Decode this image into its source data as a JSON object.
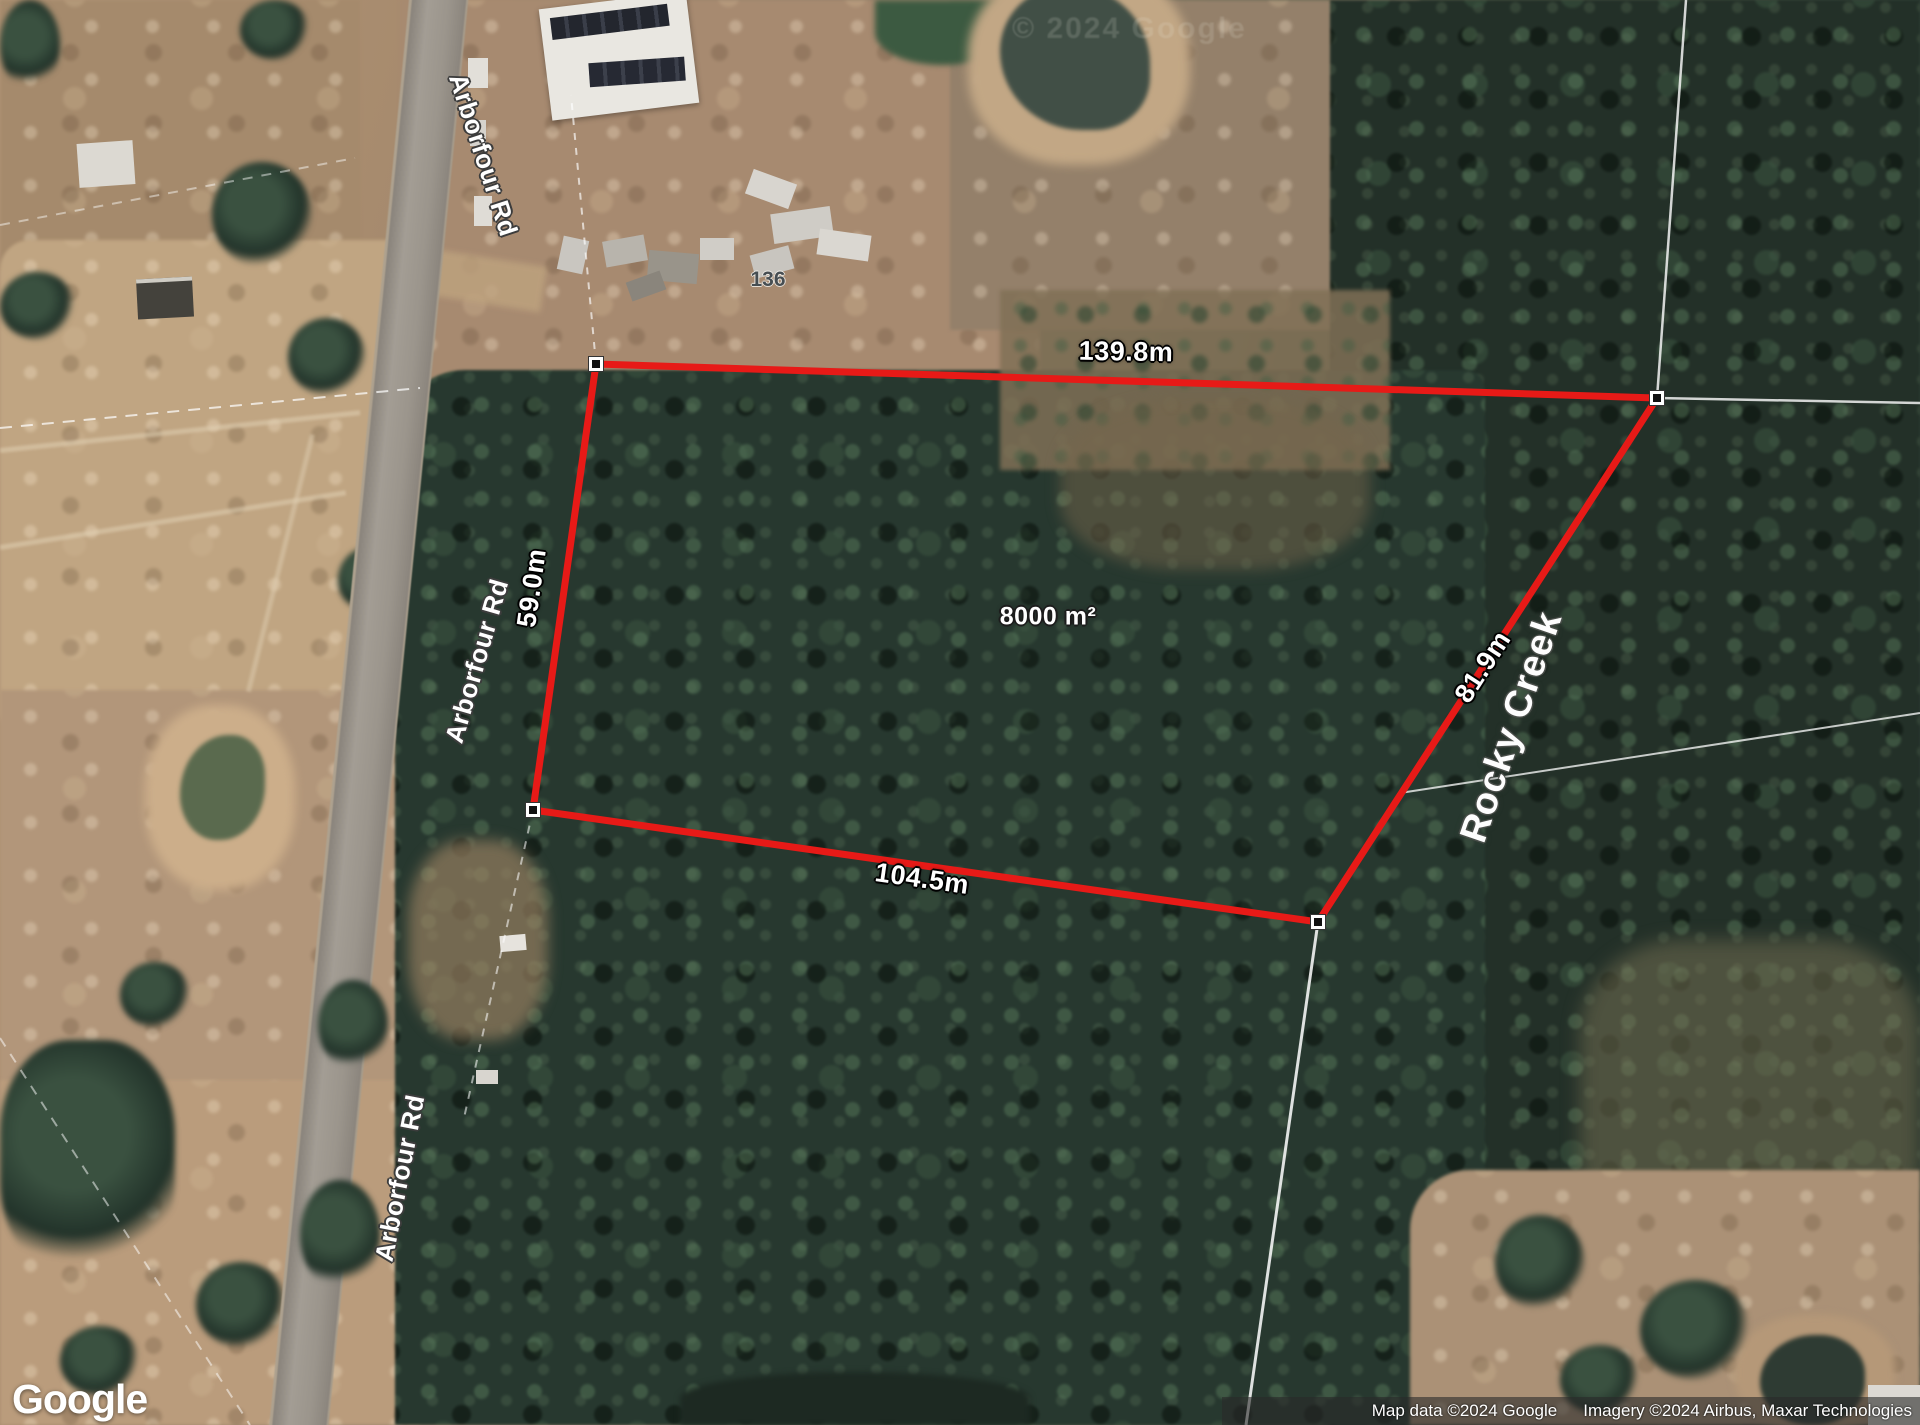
{
  "map": {
    "provider_watermark": "© 2024 Google",
    "road_label": "Arborfour Rd",
    "creek_label": "Rocky Creek",
    "house_number": "136"
  },
  "parcel": {
    "area_label": "8000 m²",
    "side_top": "139.8m",
    "side_left": "59.0m",
    "side_bottom": "104.5m",
    "side_right": "81.9m",
    "boundary_color": "#e71a17",
    "vertex_outer_color": "#ffffff",
    "vertex_inner_color": "#111111"
  },
  "footer": {
    "logo_text": "Google",
    "attribution_left": "Map data ©2024 Google",
    "attribution_right": "Imagery ©2024 Airbus, Maxar Technologies"
  }
}
